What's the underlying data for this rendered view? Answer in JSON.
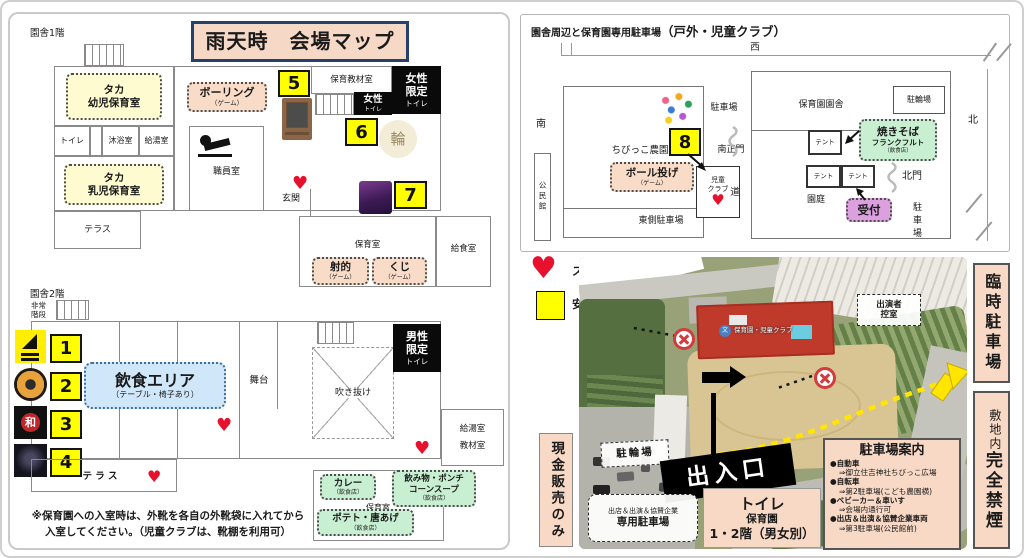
{
  "title": "雨天時　会場マップ",
  "icons": {
    "heart": "♥",
    "school_char": "文",
    "wa_char": "和",
    "rin_char": "輪"
  },
  "left": {
    "floor1_label": "園舎1階",
    "floor2_label": "園舎2階",
    "f1": {
      "youji_room": "タカ\n幼児保育室",
      "toilet": "トイレ",
      "mokuyoku": "沐浴室",
      "kyuto": "給湯室",
      "nyuji_room": "タカ\n乳児保育室",
      "terrace": "テラス",
      "bowling": "ボーリング",
      "bowling_sub": "（ゲーム）",
      "staff_room": "職員室",
      "entrance": "玄関",
      "num5": "5",
      "kyozai_room": "保育教材室",
      "women_toilet_1": "女性",
      "women_toilet_2": "トイレ",
      "women_only_1": "女性\n限定",
      "women_only_2": "トイレ",
      "num6": "6",
      "num7": "7",
      "hoiku_room": "保育室",
      "shateki": "射的",
      "shateki_sub": "（ゲーム）",
      "kuji": "くじ",
      "kuji_sub": "（ゲーム）",
      "kyushoku_room": "給食室"
    },
    "f2": {
      "hijo_kaidan": "非常\n階段",
      "num1": "1",
      "num2": "2",
      "num3": "3",
      "num4": "4",
      "eat_area": "飲食エリア",
      "eat_area_sub": "（テーブル・椅子あり）",
      "stage": "舞台",
      "atrium": "吹き抜け",
      "men_only_1": "男性\n限定",
      "men_only_2": "トイレ",
      "right_rooms": "給湯室\n教材室",
      "terrace": "テ ラ ス",
      "curry": "カレー",
      "curry_sub": "（飲食店）",
      "drink": "飲み物・ポンチ\nコーンスープ",
      "drink_sub": "（飲食店）",
      "hoiku_room": "保育室",
      "potato": "ポテト・唐あげ",
      "potato_sub": "（飲食店）"
    },
    "note": "※保育園への入室時は、外靴を各自の外靴袋に入れてから\n入室してください。（児童クラブは、靴棚を利用可）"
  },
  "outdoor": {
    "title_1": "園舎周辺と保育園専用駐車場",
    "title_2": "（戸外・児童クラブ）",
    "dir_west": "西",
    "dir_south": "南",
    "dir_north": "北",
    "kominkan": "公民館",
    "parking_label": "駐車場",
    "chibikko_farm": "ちびっこ農園",
    "num8": "8",
    "south_gate": "南正門",
    "ball_game": "ボール投げ",
    "ball_game_sub": "（ゲーム）",
    "jido_club": "児童\nクラブ",
    "road": "道",
    "east_parking": "東側駐車場",
    "ensha": "保育園園舎",
    "churinjo": "駐輪場",
    "tent1": "テント",
    "tent2": "テント",
    "tent3": "テント",
    "yakisoba": "焼きそば",
    "yakisoba_2": "フランクフルト",
    "yakisoba_sub": "（飲食店）",
    "north_gate": "北門",
    "reception": "受付",
    "entei": "園庭",
    "parking_vertical": "駐車場"
  },
  "legend": {
    "stamp_label": "スタンプラリーポイント（5か所）",
    "coop_label": "安室中学校区・主催者関係協力店（8か所）"
  },
  "photo": {
    "building_label": "保育園・児童クラブ",
    "dressing_room": "出演者\n控室",
    "churinjo": "駐輪場",
    "gate_banner": "出入口",
    "vendor_parking_1": "出店＆出演＆協賛企業",
    "vendor_parking_2": "専用駐車場",
    "toilet_1": "トイレ",
    "toilet_2": "保育園",
    "toilet_3": "1・2階（男女別）",
    "guide_title": "駐車場案内",
    "guide_items": [
      {
        "head": "●自動車",
        "sub": "⇒御立住吉神社ちびっこ広場"
      },
      {
        "head": "●自転車",
        "sub": "⇒第2駐車場(こども農園横)"
      },
      {
        "head": "●ベビーカー＆車いす",
        "sub": "⇒会場内通行可"
      },
      {
        "head": "●出店＆出演＆協賛企業車両",
        "sub": "⇒第3駐車場(公民館前)"
      }
    ],
    "cash_only": "現金販売のみ",
    "temp_parking": "臨時駐車場",
    "no_smoking_1": "敷地内",
    "no_smoking_2": "完全禁煙"
  },
  "colors": {
    "accent_pink": "#F7D9C5",
    "highlight_yellow": "#FFFF00",
    "room_yellow": "#FFFBD0",
    "food_green": "#C9EFD2",
    "area_blue": "#CFE7F8",
    "reception_purple": "#DCA0DF",
    "heart_red": "#E8112D",
    "navy_border": "#24406B"
  }
}
